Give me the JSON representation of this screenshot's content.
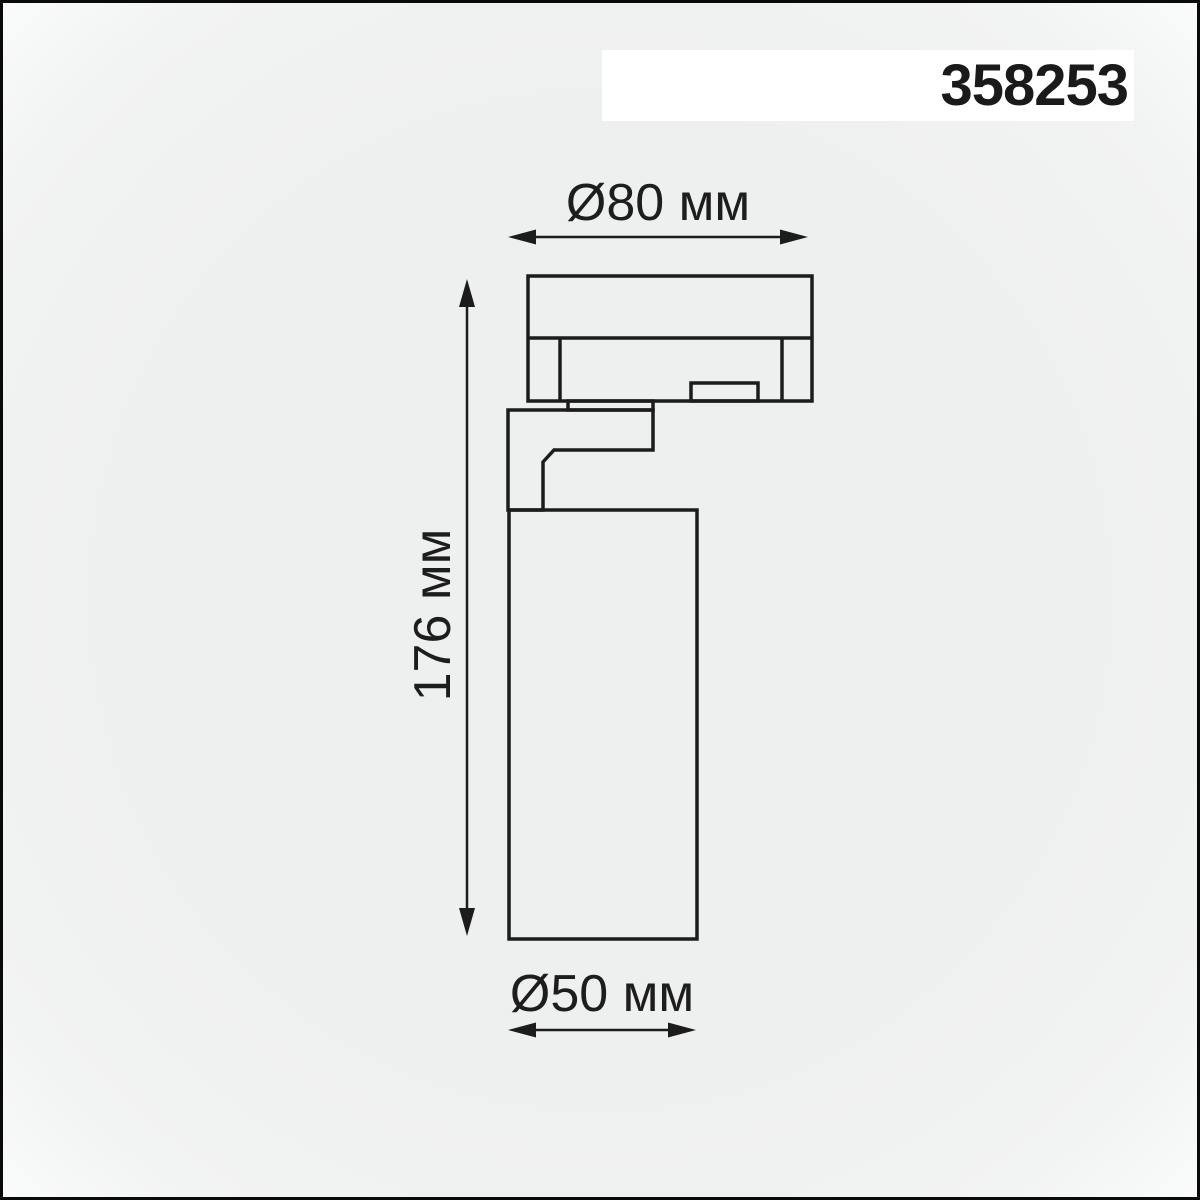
{
  "header": {
    "product_number": "358253"
  },
  "diagram": {
    "description": "Technical dimension drawing of a track-mounted spotlight, side view",
    "dimensions": {
      "top": {
        "label": "Ø80 мм",
        "value_mm": 80,
        "kind": "diameter-of-track-adapter"
      },
      "left": {
        "label": "176 мм",
        "value_mm": 176,
        "kind": "overall-height"
      },
      "bottom": {
        "label": "Ø50 мм",
        "value_mm": 50,
        "kind": "diameter-of-lamp-body"
      }
    },
    "colors": {
      "line": "#1c1c1c",
      "background": "#f0f1f1",
      "title_box": "#ffffff",
      "frame_border": "#0a0a0a"
    }
  }
}
